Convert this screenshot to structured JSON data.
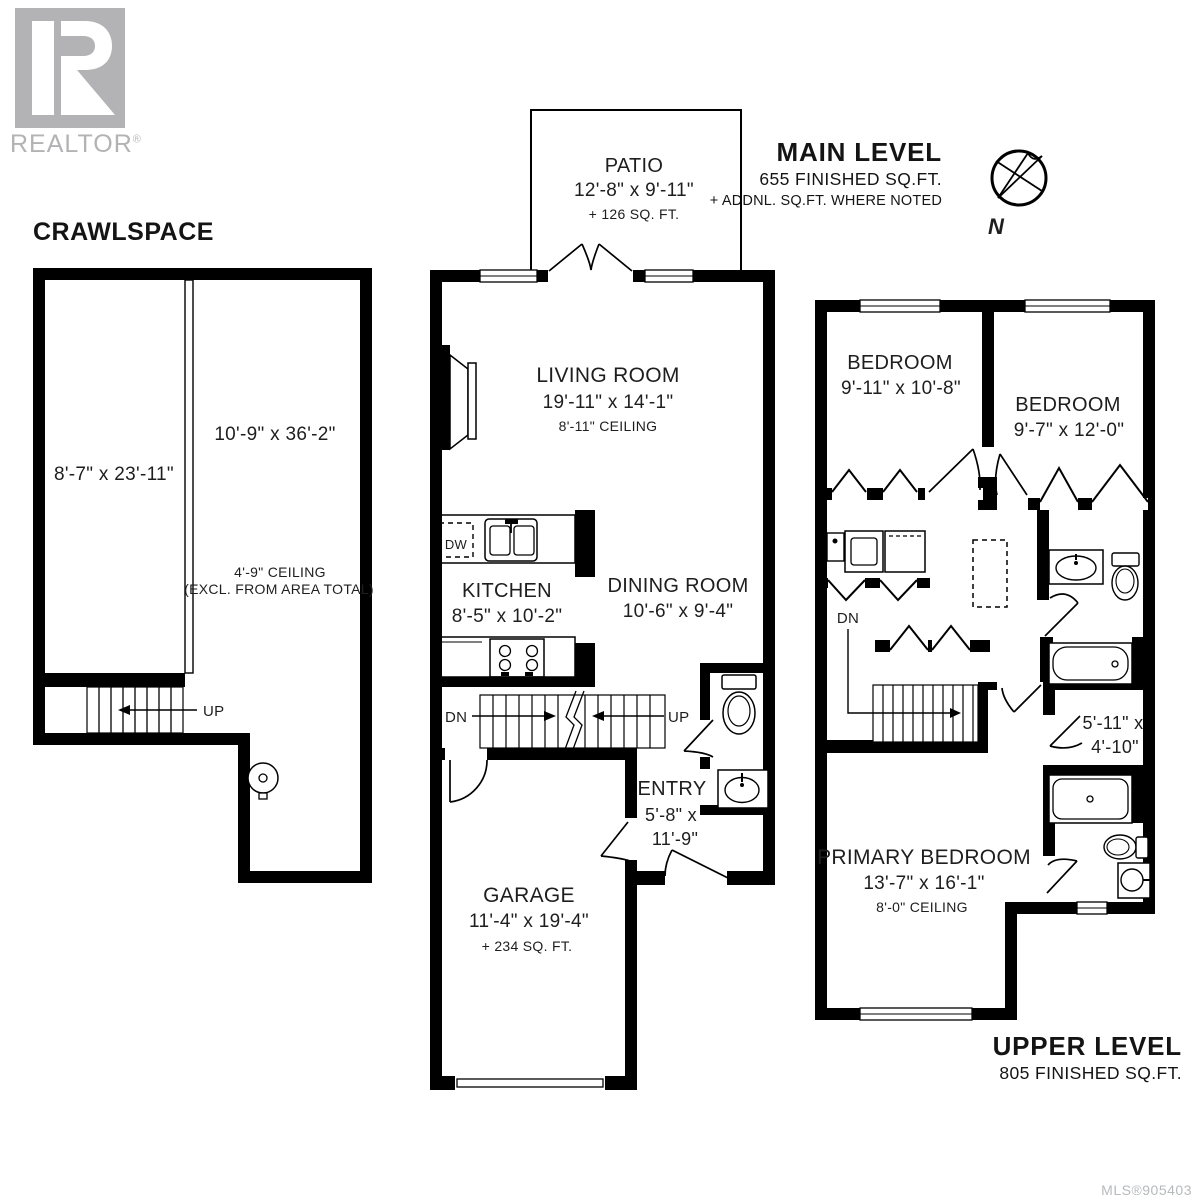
{
  "page": {
    "crawlspace_title": "CRAWLSPACE",
    "mls_number": "MLS®905403"
  },
  "branding": {
    "realtor_wordmark": "REALTOR",
    "registered_mark": "®"
  },
  "headers": {
    "main": {
      "title": "MAIN LEVEL",
      "area": "655 FINISHED SQ.FT.",
      "note": "+ ADDNL. SQ.FT. WHERE NOTED"
    },
    "upper": {
      "title": "UPPER LEVEL",
      "area": "805 FINISHED SQ.FT."
    },
    "compass_north": "N"
  },
  "crawlspace": {
    "room_left_dims": "8'-7\" x 23'-11\"",
    "room_right_dims": "10'-9\" x 36'-2\"",
    "ceiling_note_1": "4'-9\" CEILING",
    "ceiling_note_2": "(EXCL. FROM AREA TOTAL)",
    "stair_up": "UP"
  },
  "main_level": {
    "patio_name": "PATIO",
    "patio_dims": "12'-8\" x 9'-11\"",
    "patio_area": "+ 126 SQ. FT.",
    "living_name": "LIVING ROOM",
    "living_dims": "19'-11\" x 14'-1\"",
    "living_ceiling": "8'-11\" CEILING",
    "kitchen_name": "KITCHEN",
    "kitchen_dims": "8'-5\" x 10'-2\"",
    "dishwasher_label": "DW",
    "dining_name": "DINING ROOM",
    "dining_dims": "10'-6\" x 9'-4\"",
    "entry_name": "ENTRY",
    "entry_dims_1": "5'-8\" x",
    "entry_dims_2": "11'-9\"",
    "garage_name": "GARAGE",
    "garage_dims": "11'-4\" x 19'-4\"",
    "garage_area": "+ 234 SQ. FT.",
    "stair_down": "DN",
    "stair_up": "UP"
  },
  "upper_level": {
    "bedroom1_name": "BEDROOM",
    "bedroom1_dims": "9'-11\" x 10'-8\"",
    "bedroom2_name": "BEDROOM",
    "bedroom2_dims": "9'-7\" x 12'-0\"",
    "primary_name": "PRIMARY BEDROOM",
    "primary_dims": "13'-7\" x 16'-1\"",
    "primary_ceiling": "8'-0\" CEILING",
    "closet_dims_1": "5'-11\" x",
    "closet_dims_2": "4'-10\"",
    "stair_down": "DN"
  }
}
